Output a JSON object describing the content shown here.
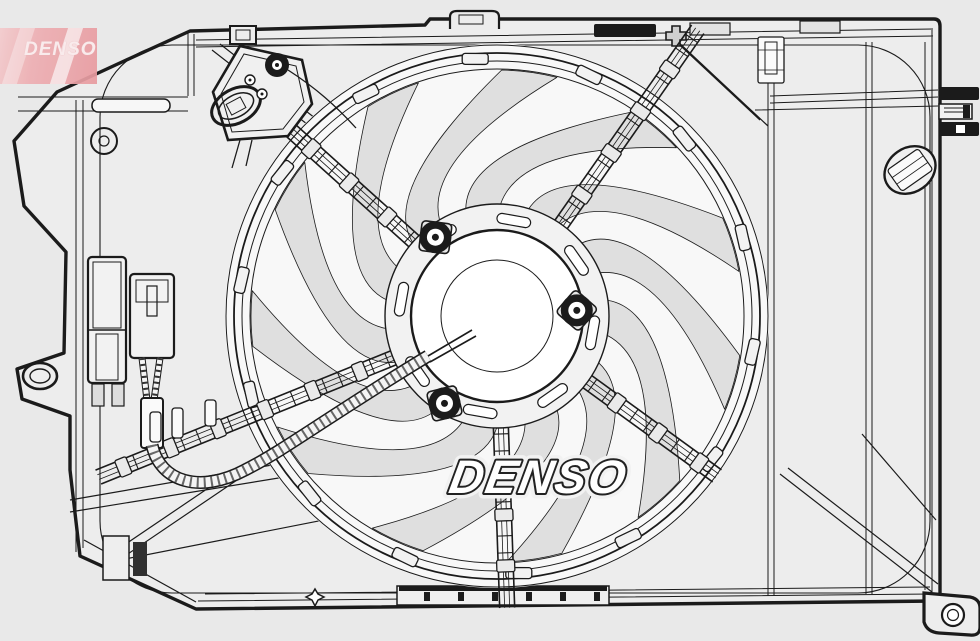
{
  "canvas": {
    "width": 980,
    "height": 641,
    "background": "#e9e9e9"
  },
  "colors": {
    "line": "#1b1b1b",
    "line_soft": "#4a4a4a",
    "panel_fill": "#ededed",
    "fan_face": "#f8f8f8",
    "blade_fill": "#dfdfdf",
    "hub_fill": "#ffffff",
    "clip_fill": "#f2f2f2",
    "black_fill": "#1b1b1b",
    "watermark_fill": "#ffffff",
    "watermark_stroke": "#222222",
    "logo_pink": "#eba4a8",
    "logo_text_color": "#fbeced"
  },
  "watermark": {
    "text": "DENSO"
  },
  "brand_logo": {
    "text": "DENSO"
  },
  "figure": {
    "type": "technical-drawing",
    "subject": "engine cooling fan with shroud assembly",
    "center": [
      497,
      316
    ],
    "fan_face_radius": 272,
    "ring_radii": [
      247,
      255,
      263,
      271
    ],
    "blade_count": 11,
    "blade_inner_radius": 112,
    "blade_outer_radius": 246,
    "blade_sweep_deg": 50,
    "rim_clip_count": 14,
    "rim_clip_radius": 258,
    "hub": {
      "ring_radius": 112,
      "face_radius": 86,
      "inner_radius": 56,
      "slot_count": 8,
      "slot_radius": 97,
      "bolts": [
        {
          "angle": -128,
          "r": 100
        },
        {
          "angle": -4,
          "r": 80
        },
        {
          "angle": 121,
          "r": 102
        }
      ]
    },
    "struts": [
      {
        "angle": -138,
        "outer": 285
      },
      {
        "angle": -55,
        "outer": 350
      },
      {
        "angle": 36,
        "outer": 272
      },
      {
        "angle": 88,
        "outer": 292
      },
      {
        "angle": 158,
        "outer": 430
      }
    ],
    "strut_inner": 106,
    "strut_half_width": 7.5,
    "strut_rung_gap": 17
  }
}
